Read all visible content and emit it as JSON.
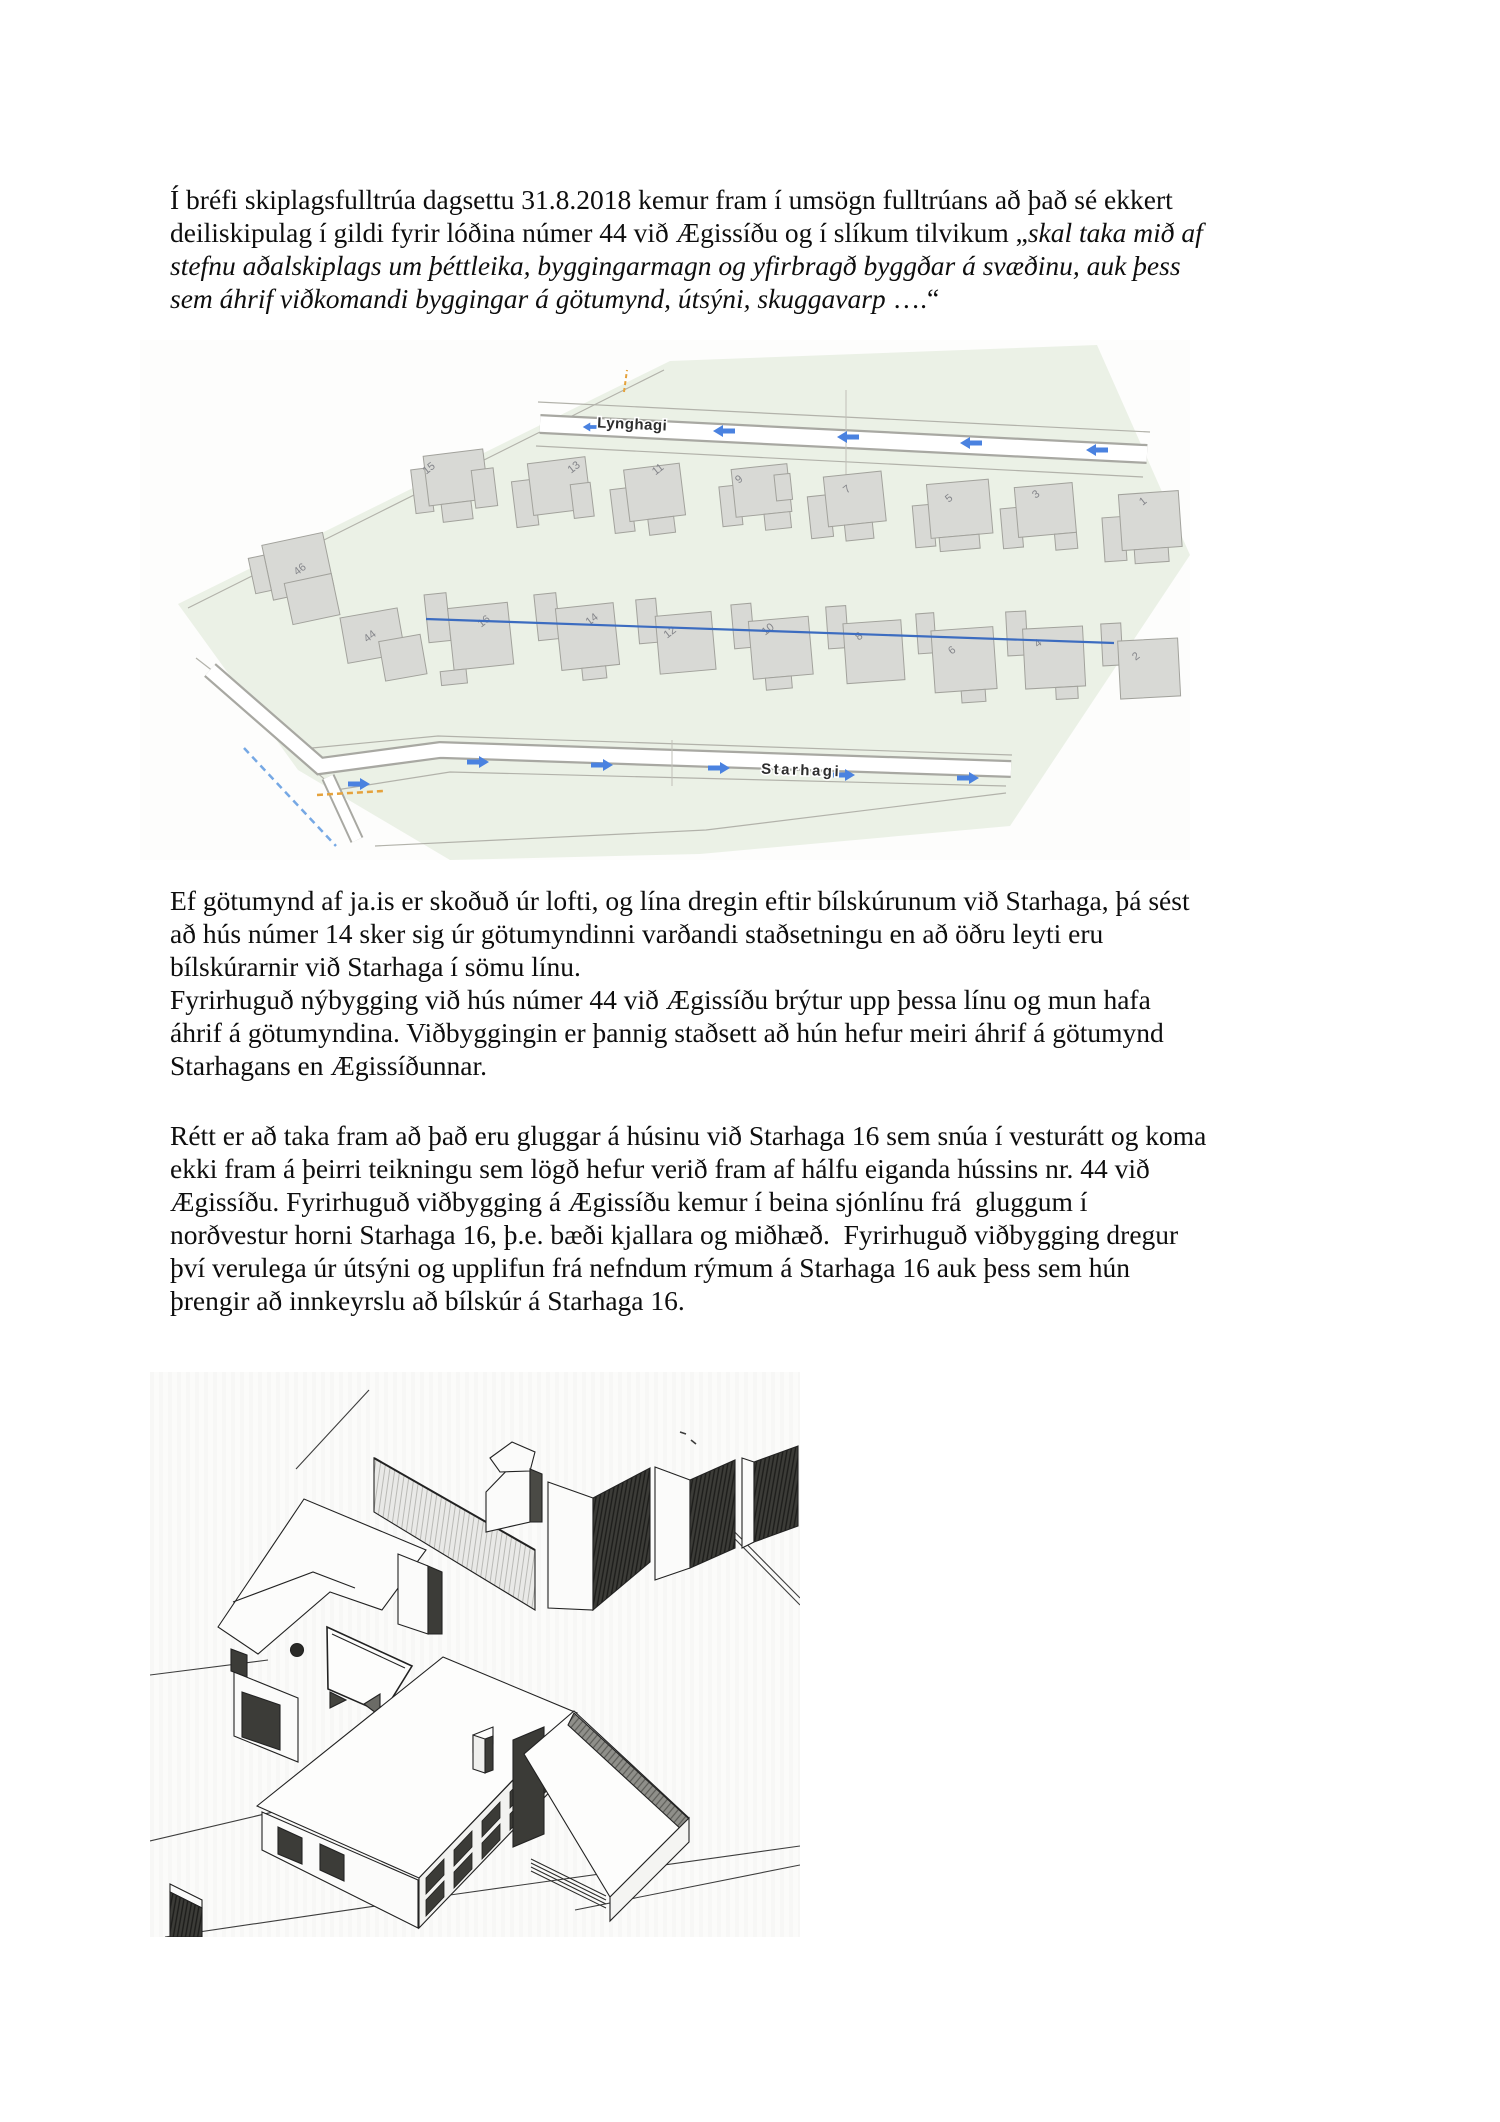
{
  "document": {
    "blocks": [
      {
        "top": 183,
        "lines": [
          [
            {
              "t": "Í bréfi skiplagsfulltrúa dagsettu 31.8.2018 kemur fram í umsögn fulltrúans að það sé ekkert",
              "i": false
            }
          ],
          [
            {
              "t": "deiliskipulag í gildi fyrir lóðina númer 44 við Ægissíðu og í slíkum tilvikum „",
              "i": false
            },
            {
              "t": "skal taka mið af",
              "i": true
            }
          ],
          [
            {
              "t": "stefnu aðalskiplags um þéttleika, byggingarmagn og yfirbragð byggðar á svæðinu, auk þess",
              "i": true
            }
          ],
          [
            {
              "t": "sem áhrif viðkomandi byggingar á götumynd, útsýni, skuggavarp ",
              "i": true
            },
            {
              "t": "….“",
              "i": false
            }
          ]
        ]
      },
      {
        "top": 884,
        "lines": [
          [
            {
              "t": "Ef götumynd af ja.is er skoðuð úr lofti, og lína dregin eftir bílskúrunum við Starhaga, þá sést",
              "i": false
            }
          ],
          [
            {
              "t": "að hús númer 14 sker sig úr götumyndinni varðandi staðsetningu en að öðru leyti eru",
              "i": false
            }
          ],
          [
            {
              "t": "bílskúrarnir við Starhaga í sömu línu.",
              "i": false
            }
          ],
          [
            {
              "t": "Fyrirhuguð nýbygging við hús númer 44 við Ægissíðu brýtur upp þessa línu og mun hafa",
              "i": false
            }
          ],
          [
            {
              "t": "áhrif á götumyndina. Viðbyggingin er þannig staðsett að hún hefur meiri áhrif á götumynd",
              "i": false
            }
          ],
          [
            {
              "t": "Starhagans en Ægissíðunnar.",
              "i": false
            }
          ]
        ]
      },
      {
        "top": 1119,
        "lines": [
          [
            {
              "t": "Rétt er að taka fram að það eru gluggar á húsinu við Starhaga 16 sem snúa í vesturátt og koma",
              "i": false
            }
          ],
          [
            {
              "t": "ekki fram á þeirri teikningu sem lögð hefur verið fram af hálfu eiganda hússins nr. 44 við",
              "i": false
            }
          ],
          [
            {
              "t": "Ægissíðu. Fyrirhuguð viðbygging á Ægissíðu kemur í beina sjónlínu frá  gluggum í",
              "i": false
            }
          ],
          [
            {
              "t": "norðvestur horni Starhaga 16, þ.e. bæði kjallara og miðhæð.  Fyrirhuguð viðbygging dregur",
              "i": false
            }
          ],
          [
            {
              "t": "því verulega úr útsýni og upplifun frá nefndum rýmum á Starhaga 16 auk þess sem hún",
              "i": false
            }
          ],
          [
            {
              "t": "þrengir að innkeyrslu að bílskúr á Starhaga 16.",
              "i": false
            }
          ]
        ]
      }
    ]
  },
  "map": {
    "street_labels": [
      {
        "text": "Lynghagi",
        "x": 492,
        "y": 89,
        "rot": 2.5,
        "spacing": 0.5
      },
      {
        "text": "Starhagi",
        "x": 661,
        "y": 435,
        "rot": 2,
        "spacing": 2.5
      }
    ],
    "arrows": [
      {
        "x": 451,
        "y": 87,
        "dir": "left",
        "s": 0.75
      },
      {
        "x": 584,
        "y": 91,
        "dir": "left",
        "s": 1
      },
      {
        "x": 708,
        "y": 97,
        "dir": "left",
        "s": 1
      },
      {
        "x": 831,
        "y": 103,
        "dir": "left",
        "s": 1
      },
      {
        "x": 957,
        "y": 110,
        "dir": "left",
        "s": 1
      },
      {
        "x": 219,
        "y": 444,
        "dir": "right",
        "s": 1
      },
      {
        "x": 338,
        "y": 422,
        "dir": "right",
        "s": 1
      },
      {
        "x": 462,
        "y": 425,
        "dir": "right",
        "s": 1
      },
      {
        "x": 579,
        "y": 428,
        "dir": "right",
        "s": 1
      },
      {
        "x": 704,
        "y": 435,
        "dir": "right",
        "s": 1
      },
      {
        "x": 828,
        "y": 438,
        "dir": "right",
        "s": 1
      }
    ],
    "buildings": [
      {
        "label": "15",
        "x": 269,
        "y": 116,
        "rot": -7,
        "lx": 291,
        "ly": 131,
        "parts": [
          [
            0,
            14,
            18,
            44
          ],
          [
            14,
            2,
            60,
            50
          ],
          [
            60,
            22,
            22,
            38
          ],
          [
            26,
            52,
            30,
            18
          ]
        ]
      },
      {
        "label": "13",
        "x": 369,
        "y": 122,
        "rot": -7,
        "lx": 436,
        "ly": 130,
        "parts": [
          [
            0,
            20,
            22,
            46
          ],
          [
            18,
            4,
            58,
            52
          ],
          [
            58,
            30,
            20,
            34
          ]
        ]
      },
      {
        "label": "11",
        "x": 467,
        "y": 126,
        "rot": -7,
        "lx": 520,
        "ly": 132,
        "parts": [
          [
            0,
            24,
            20,
            44
          ],
          [
            16,
            6,
            56,
            52
          ],
          [
            34,
            58,
            26,
            16
          ]
        ]
      },
      {
        "label": "9",
        "x": 577,
        "y": 129,
        "rot": -6,
        "lx": 601,
        "ly": 142,
        "parts": [
          [
            0,
            18,
            20,
            40
          ],
          [
            14,
            2,
            56,
            48
          ],
          [
            42,
            50,
            26,
            16
          ],
          [
            56,
            12,
            16,
            26
          ]
        ]
      },
      {
        "label": "7",
        "x": 665,
        "y": 135,
        "rot": -6,
        "lx": 709,
        "ly": 152,
        "parts": [
          [
            0,
            22,
            22,
            42
          ],
          [
            18,
            4,
            58,
            50
          ],
          [
            34,
            54,
            28,
            16
          ]
        ]
      },
      {
        "label": "5",
        "x": 770,
        "y": 140,
        "rot": -5,
        "lx": 811,
        "ly": 161,
        "parts": [
          [
            0,
            26,
            20,
            42
          ],
          [
            16,
            6,
            62,
            54
          ],
          [
            24,
            60,
            40,
            14
          ]
        ]
      },
      {
        "label": "3",
        "x": 858,
        "y": 145,
        "rot": -5,
        "lx": 898,
        "ly": 157,
        "parts": [
          [
            0,
            24,
            20,
            40
          ],
          [
            16,
            4,
            58,
            50
          ],
          [
            52,
            54,
            22,
            16
          ]
        ]
      },
      {
        "label": "1",
        "x": 960,
        "y": 150,
        "rot": -4,
        "lx": 1005,
        "ly": 164,
        "parts": [
          [
            0,
            28,
            22,
            44
          ],
          [
            18,
            6,
            60,
            56
          ],
          [
            30,
            62,
            34,
            14
          ]
        ]
      },
      {
        "label": "46",
        "x": 114,
        "y": 207,
        "rot": -12,
        "lx": 162,
        "ly": 232,
        "parts": [
          [
            8,
            0,
            62,
            56
          ],
          [
            22,
            42,
            48,
            42
          ],
          [
            -8,
            10,
            16,
            36
          ]
        ]
      },
      {
        "label": "44",
        "x": 200,
        "y": 278,
        "rot": -10,
        "lx": 232,
        "ly": 299,
        "parts": [
          [
            0,
            0,
            58,
            46
          ],
          [
            34,
            30,
            42,
            40
          ]
        ]
      },
      {
        "label": "16",
        "x": 283,
        "y": 245,
        "rot": -6,
        "lx": 346,
        "ly": 284,
        "parts": [
          [
            0,
            10,
            22,
            48
          ],
          [
            22,
            26,
            60,
            62
          ],
          [
            8,
            88,
            26,
            14
          ]
        ]
      },
      {
        "label": "14",
        "x": 393,
        "y": 247,
        "rot": -6,
        "lx": 454,
        "ly": 282,
        "parts": [
          [
            0,
            8,
            22,
            46
          ],
          [
            20,
            24,
            58,
            62
          ],
          [
            40,
            86,
            24,
            12
          ]
        ]
      },
      {
        "label": "12",
        "x": 495,
        "y": 252,
        "rot": -5,
        "lx": 532,
        "ly": 295,
        "parts": [
          [
            0,
            8,
            20,
            44
          ],
          [
            18,
            26,
            56,
            58
          ]
        ]
      },
      {
        "label": "10",
        "x": 590,
        "y": 255,
        "rot": -5,
        "lx": 630,
        "ly": 292,
        "parts": [
          [
            0,
            10,
            20,
            44
          ],
          [
            16,
            28,
            60,
            58
          ],
          [
            28,
            86,
            26,
            12
          ]
        ]
      },
      {
        "label": "8",
        "x": 685,
        "y": 257,
        "rot": -4,
        "lx": 721,
        "ly": 299,
        "parts": [
          [
            0,
            10,
            20,
            42
          ],
          [
            16,
            28,
            58,
            60
          ]
        ]
      },
      {
        "label": "6",
        "x": 775,
        "y": 264,
        "rot": -4,
        "lx": 814,
        "ly": 313,
        "parts": [
          [
            0,
            10,
            18,
            40
          ],
          [
            14,
            28,
            62,
            62
          ],
          [
            40,
            90,
            24,
            12
          ]
        ]
      },
      {
        "label": "4",
        "x": 865,
        "y": 260,
        "rot": -3,
        "lx": 900,
        "ly": 306,
        "parts": [
          [
            0,
            12,
            20,
            44
          ],
          [
            16,
            30,
            60,
            60
          ],
          [
            46,
            90,
            22,
            12
          ]
        ]
      },
      {
        "label": "2",
        "x": 960,
        "y": 270,
        "rot": -3,
        "lx": 998,
        "ly": 319,
        "parts": [
          [
            0,
            14,
            20,
            42
          ],
          [
            16,
            32,
            60,
            58
          ]
        ]
      }
    ],
    "colors": {
      "land": "#ebf1e6",
      "building_fill": "#d8d9d5",
      "building_stroke": "#a2a29c",
      "arrow_blue": "#4a82e0",
      "sight_line_blue": "#3c6cc0",
      "dashed_blue": "#5f9ae0",
      "dashed_orange": "#e5a23c",
      "road_casing": "#a8a8a2"
    }
  }
}
